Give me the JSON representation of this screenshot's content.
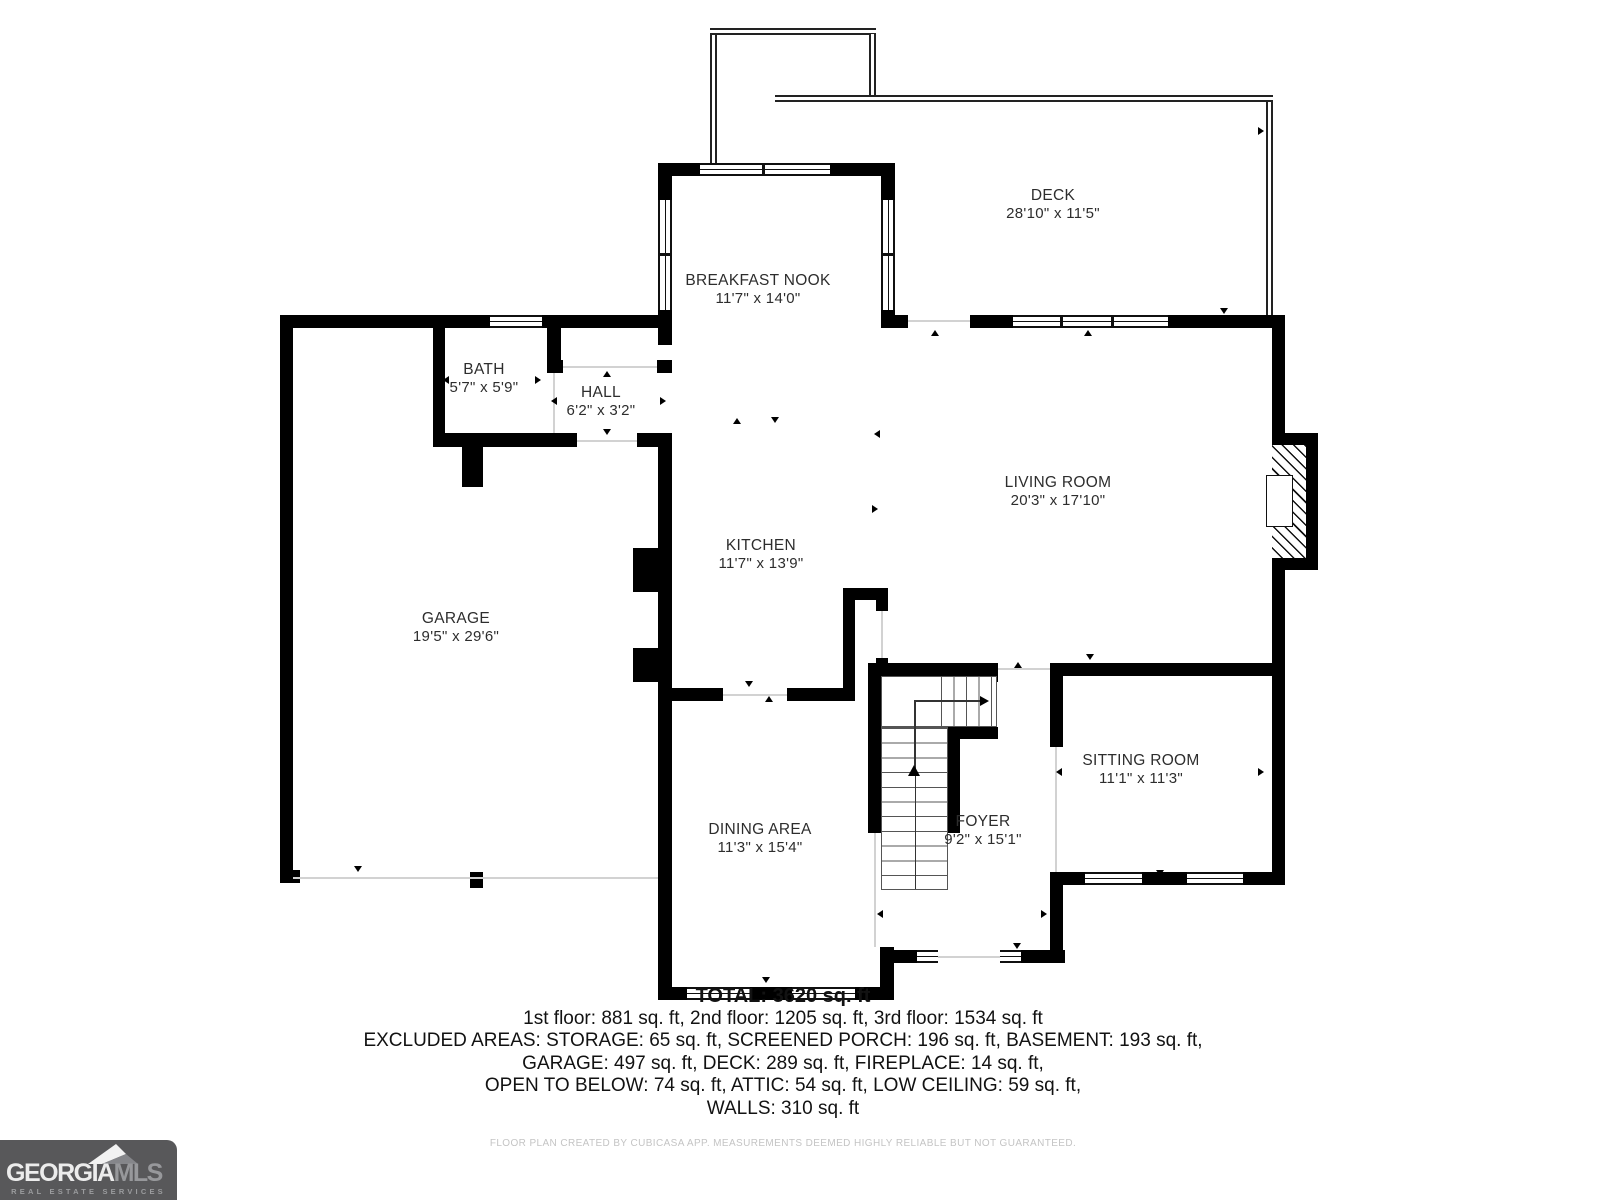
{
  "rooms": [
    {
      "name": "DECK",
      "dims": "28'10\" x 11'5\""
    },
    {
      "name": "BREAKFAST NOOK",
      "dims": "11'7\" x 14'0\""
    },
    {
      "name": "BATH",
      "dims": "5'7\" x 5'9\""
    },
    {
      "name": "HALL",
      "dims": "6'2\" x 3'2\""
    },
    {
      "name": "GARAGE",
      "dims": "19'5\" x 29'6\""
    },
    {
      "name": "KITCHEN",
      "dims": "11'7\" x 13'9\""
    },
    {
      "name": "LIVING ROOM",
      "dims": "20'3\" x 17'10\""
    },
    {
      "name": "DINING AREA",
      "dims": "11'3\" x 15'4\""
    },
    {
      "name": "FOYER",
      "dims": "9'2\" x 15'1\""
    },
    {
      "name": "SITTING ROOM",
      "dims": "11'1\" x 11'3\""
    }
  ],
  "summary": {
    "total": "TOTAL: 3620 sq. ft",
    "floors": "1st floor: 881 sq. ft, 2nd floor: 1205 sq. ft, 3rd floor: 1534 sq. ft",
    "excluded1": "EXCLUDED AREAS: STORAGE: 65 sq. ft, SCREENED PORCH: 196 sq. ft, BASEMENT: 193 sq. ft,",
    "excluded2": "GARAGE: 497 sq. ft, DECK: 289 sq. ft, FIREPLACE: 14 sq. ft,",
    "excluded3": "OPEN TO BELOW: 74 sq. ft, ATTIC: 54 sq. ft, LOW CEILING: 59 sq. ft,",
    "excluded4": "WALLS: 310 sq. ft"
  },
  "disclaimer": "FLOOR PLAN CREATED BY CUBICASA APP. MEASUREMENTS DEEMED HIGHLY RELIABLE BUT NOT GUARANTEED.",
  "logo": {
    "brand_primary": "GEORGIA",
    "brand_secondary": "MLS",
    "tagline": "REAL ESTATE SERVICES"
  },
  "colors": {
    "wall": "#000000",
    "logo_background": "#58585a",
    "logo_text_light": "#ececec",
    "logo_text_gray": "#97989b",
    "disclaimer_text": "#c4c4c4"
  }
}
